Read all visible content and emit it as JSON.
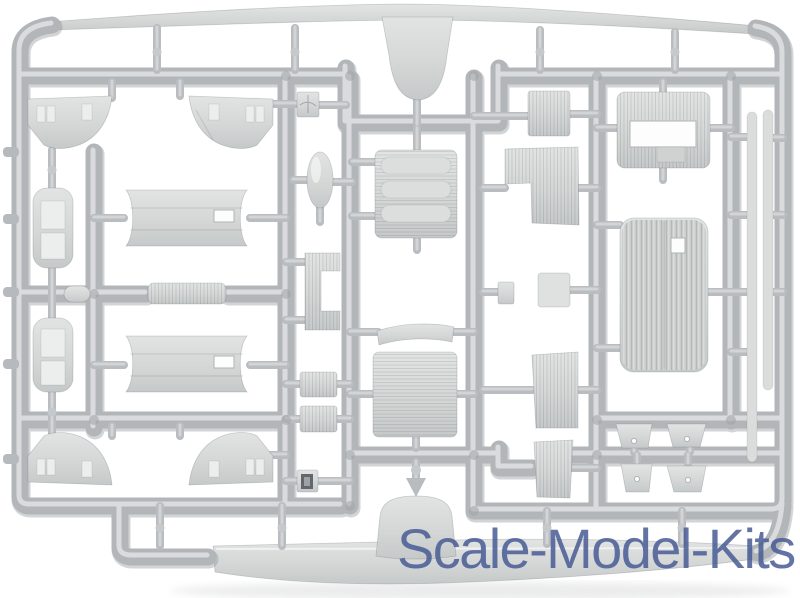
{
  "scene": {
    "type": "product-photo",
    "subject": "light gray injection-molded plastic sprue (model kit parts tree) on white background",
    "background_color": "#ffffff",
    "runner_color": "#b3b6b9",
    "part_color": "#d2d5d4"
  },
  "watermark": {
    "text": "Scale-Model-Kits",
    "color": "#465b94"
  },
  "parts": [
    "upper-wing-panel",
    "tail-fin",
    "marked-square",
    "porthole-panel-top-left",
    "porthole-panel-top-right",
    "porthole-panel-bottom-left",
    "porthole-panel-bottom-right",
    "engine-cowling-top",
    "engine-cowling-bottom",
    "fuselage-half-top",
    "fuselage-half-bottom",
    "bullet-fairing",
    "small-ribbed-strip",
    "oval-wheel",
    "step-bracket",
    "louvered-panel",
    "curved-strip",
    "large-ribbed-plate",
    "small-ribbed-square-1",
    "small-ribbed-square-2",
    "framed-window-block",
    "small-block",
    "ribbed-plate",
    "ribbed-floor-panel",
    "small-plate",
    "ribbed-panel-lower",
    "ribbed-panel-bottom",
    "lattice-frame-plate",
    "corrugated-fuselage-panel",
    "long-strut-1",
    "long-strut-2",
    "seat-trapezoid-1",
    "seat-trapezoid-2",
    "seat-trapezoid-3",
    "seat-trapezoid-4",
    "lower-wing-panel"
  ]
}
